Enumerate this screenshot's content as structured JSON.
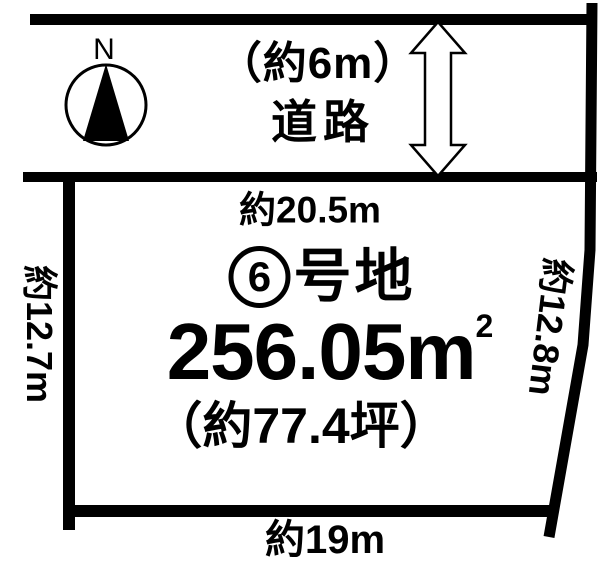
{
  "page": {
    "background": "#ffffff",
    "line_color": "#000000"
  },
  "compass": {
    "north_label": "N"
  },
  "road": {
    "width_label": "（約6m）",
    "name_label": "道路"
  },
  "plot": {
    "top_dimension": "約20.5m",
    "left_dimension": "約12.7m",
    "right_dimension": "約12.8m",
    "bottom_dimension": "約19m",
    "lot_number": "6",
    "lot_suffix": "号地",
    "area_value": "256.05m",
    "area_exponent": "2",
    "area_tsubo": "（約77.4坪）"
  }
}
